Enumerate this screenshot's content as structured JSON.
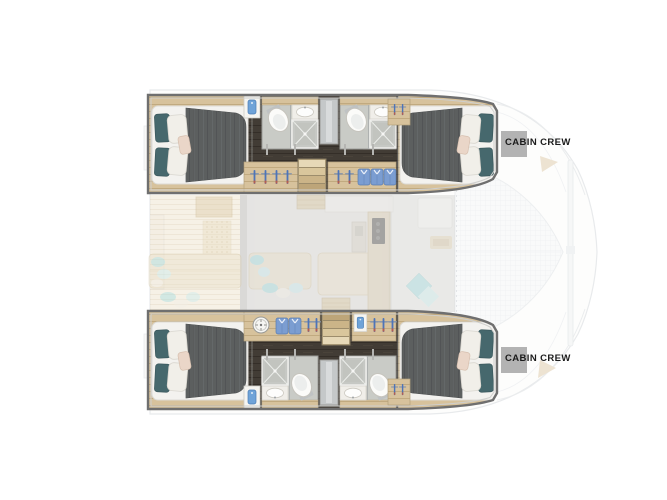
{
  "page": {
    "background": "#ffffff",
    "type": "catamaran-lower-deck-floorplan"
  },
  "labels": {
    "cabin_crew_top": "CABIN CREW",
    "cabin_crew_bottom": "CABIN CREW"
  },
  "colors": {
    "label_square": "#b3b3b3",
    "label_text": "#1b1b1b",
    "hull_frame": "#6f6f6f",
    "dark_floor": "#423c35",
    "cabin_wood": "#d7c29c",
    "duvet_gray": "#5c5f5f",
    "mattress_white": "#f3f2ef",
    "pillow_teal": "#46686d",
    "pillow_blush": "#ead6c8",
    "bathroom_gray": "#c9cbc6",
    "hanger_blue": "#4d74b8",
    "shirt_blue": "#7b9dd1",
    "stair_wood": "#c8b186",
    "accent_teal": "#a3dce0",
    "deck_wood": "#efe4cd",
    "saloon_floor": "#cac8c5",
    "outline_gray": "#d3d7da"
  }
}
